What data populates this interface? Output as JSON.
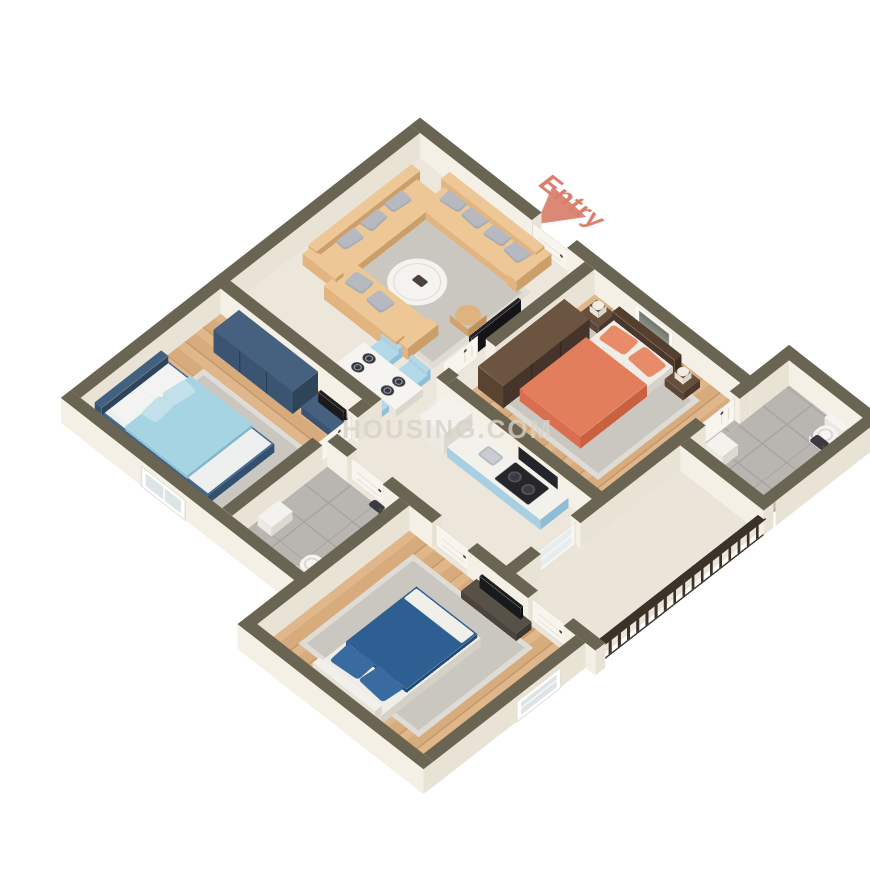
{
  "scene": {
    "entry_label": "Entry",
    "watermark": "HOUSING.COM"
  },
  "colors": {
    "wall_top": "#6a6553",
    "wall_face_bright": "#f5f0e6",
    "wall_face_shade": "#e9e3d6",
    "floor_cream": "#ece6db",
    "floor_balcony": "#eae4d9",
    "wood": "#d7ab7c",
    "wood_light": "#e0b78b",
    "wood_line": "#c4976a",
    "tile": "#b9b6b1",
    "tile_line": "#a7a49f",
    "rug": "#cac6c0",
    "rug_border": "#dfdcd6",
    "sofa": "#e2b480",
    "sofa_light": "#edc795",
    "sofa_dark": "#cb9e6a",
    "pillow_gray": "#b6bac0",
    "chair_blue": "#a9d2e5",
    "kitchen_blue": "#a9cfe2",
    "counter_top": "#f3f1ec",
    "bed_orange": "#e07a58",
    "pillow_orange": "#e78b69",
    "bed_lightblue": "#a6d4e2",
    "bed_frame_navy": "#3f5e80",
    "bed_darkblue": "#2d5f92",
    "wardrobe_navy": "#3a5471",
    "wardrobe_brown": "#594430",
    "white_furniture": "#f2efe9",
    "black_tv": "#1d1d20",
    "door_white": "#f8f5ef",
    "railing": "#3b332a",
    "entry_accent": "#d97f6d",
    "watermark_color": "#d8d2c8"
  },
  "rooms": [
    {
      "name": "living-room",
      "furniture": [
        "corner-sofa",
        "gray-pillows",
        "coffee-table",
        "side-table",
        "tv-panel",
        "rug"
      ]
    },
    {
      "name": "dining-area",
      "furniture": [
        "dining-table",
        "dining-chairs",
        "place-settings"
      ]
    },
    {
      "name": "kitchen",
      "furniture": [
        "refrigerator",
        "counter",
        "stove",
        "sink",
        "chimney-hood"
      ]
    },
    {
      "name": "master-bedroom",
      "furniture": [
        "double-bed-orange",
        "wardrobe-brown",
        "nightstands",
        "lamps",
        "wall-art",
        "rug"
      ]
    },
    {
      "name": "master-bathroom",
      "furniture": [
        "toilet",
        "shower",
        "washbasin",
        "glass-partition"
      ]
    },
    {
      "name": "bedroom-2",
      "furniture": [
        "double-bed-lightblue",
        "wardrobe-navy",
        "tv-console",
        "rug"
      ]
    },
    {
      "name": "bathroom-2",
      "furniture": [
        "toilet",
        "shower",
        "cabinet"
      ]
    },
    {
      "name": "bedroom-3",
      "furniture": [
        "double-bed-darkblue",
        "tv-console",
        "rug"
      ]
    },
    {
      "name": "balcony",
      "furniture": [
        "railing"
      ]
    }
  ]
}
